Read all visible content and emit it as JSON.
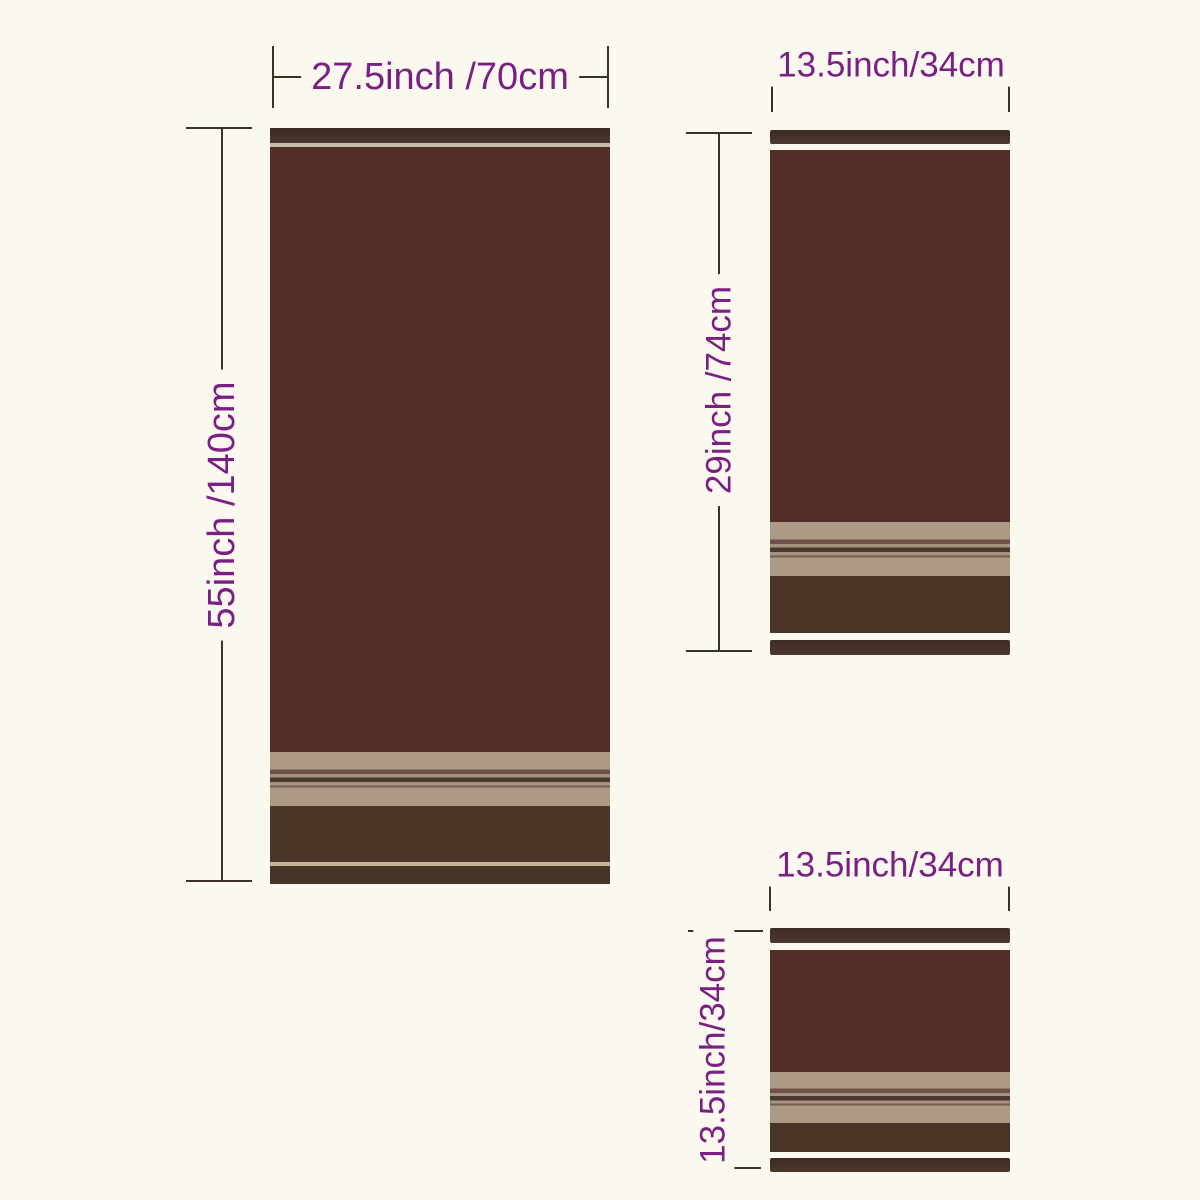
{
  "page": {
    "background_color": "#FBF8EF",
    "label_text_color": "#7B2083",
    "dimension_line_color": "#3E3126"
  },
  "colors": {
    "towel_body": "#522F26",
    "towel_hem_dark": "#453129",
    "stripe_tan": "#AC9A84",
    "stripe_brown": "#6E5149",
    "accent_light_line": "#C9BBA7"
  },
  "towels": [
    {
      "name": "bath-towel",
      "width_label": "27.5inch /70cm",
      "height_label": "55inch /140cm"
    },
    {
      "name": "hand-towel",
      "width_label": "13.5inch/34cm",
      "height_label": "29inch /74cm"
    },
    {
      "name": "washcloth",
      "width_label": "13.5inch/34cm",
      "height_label": "13.5inch/34cm"
    }
  ]
}
